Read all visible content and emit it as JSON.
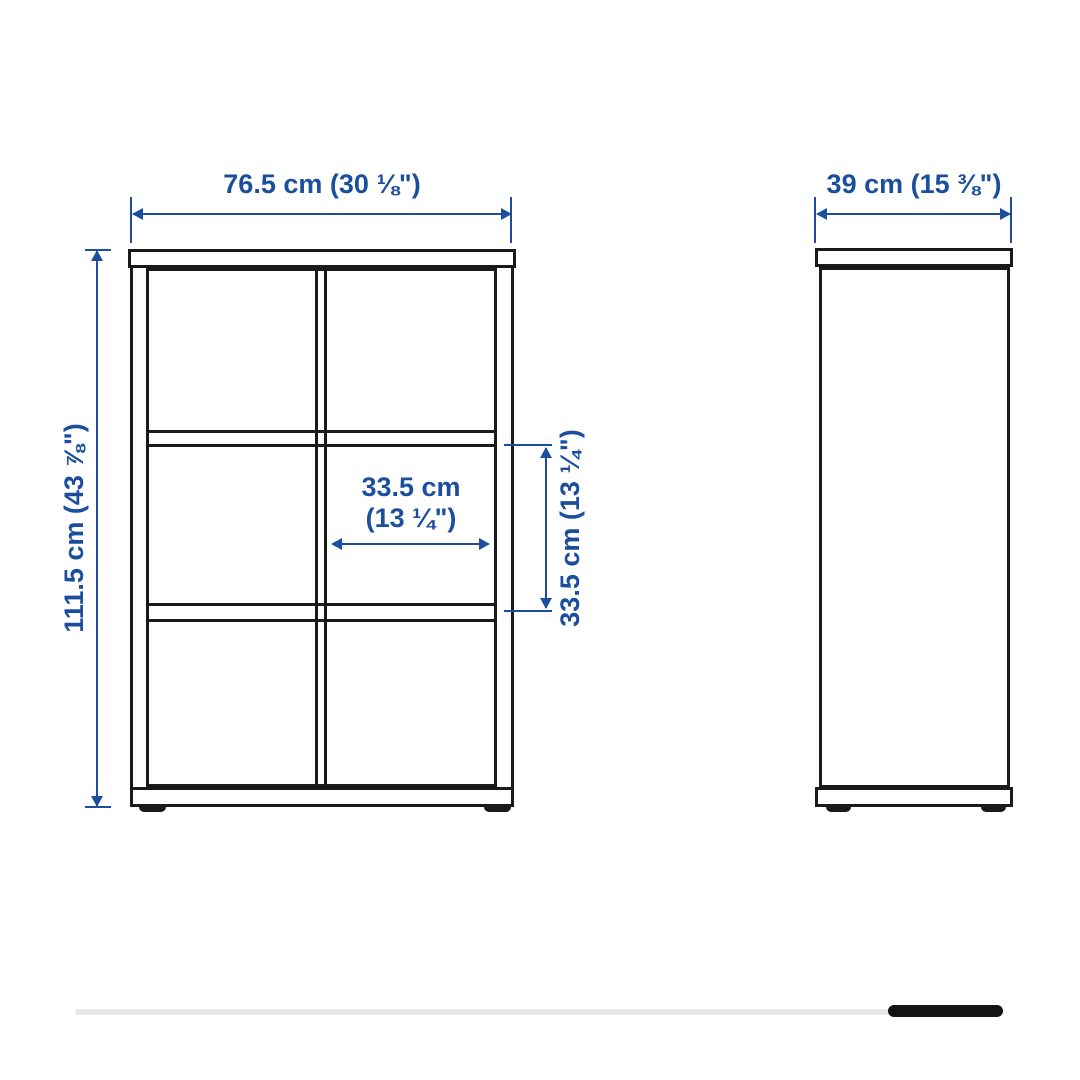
{
  "colors": {
    "background": "#ffffff",
    "cabinet_line": "#1a1a1a",
    "dimension_blue": "#1b4f9e",
    "scrollbar_track": "#e8e8e8",
    "scrollbar_thumb": "#141414"
  },
  "diagram": {
    "front_view": {
      "rows": 3,
      "columns": 2,
      "width_label": "76.5 cm (30 ⅛\")",
      "height_label": "111.5 cm (43 ⅞\")",
      "cell_width_label_line1": "33.5 cm",
      "cell_width_label_line2": "(13 ¼\")",
      "cell_height_label": "33.5 cm (13 ¼\")"
    },
    "side_view": {
      "depth_label": "39 cm (15 ⅜\")"
    }
  }
}
